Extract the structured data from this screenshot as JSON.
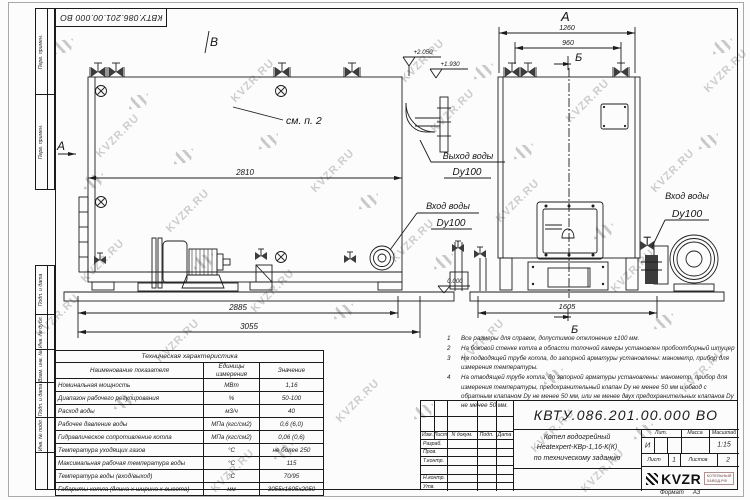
{
  "watermark": {
    "text": "KVZR.RU"
  },
  "frame": {
    "doc_number_top": "КВТУ.086.201.00.000 ВО",
    "col_perv_primen_1": "Перв. примен.",
    "col_perv_primen_2": "Перв. примен.",
    "col_podp_data_1": "Подп. и дата",
    "col_inv_dubl": "Инв. № дубл.",
    "col_vzam_inv": "Взам. инв. №",
    "col_podp_data_2": "Подп. и дата",
    "col_inv_podl": "Инв. № подл."
  },
  "drawing": {
    "side_view": {
      "label_v": "В",
      "section_a": "А",
      "see_note": "см. п. 2",
      "dim_inner": "2810",
      "dim_mid": "2885",
      "dim_total": "3055",
      "elev_top": "+2.050",
      "elev_upper": "+1.930",
      "elev_zero": "0.000",
      "outlet_title": "Выход воды",
      "outlet_dn": "Dy100",
      "inlet_title": "Вход воды",
      "inlet_dn": "Dy100"
    },
    "front_view": {
      "label_a": "А",
      "label_b_top": "Б",
      "label_b_bottom": "Б",
      "dim_outer": "1260",
      "dim_inner": "960",
      "dim_base": "1605",
      "inlet_title": "Вход воды",
      "inlet_dn": "Dy100"
    }
  },
  "notes": [
    {
      "num": "1",
      "text": "Все размеры для справок, допустимое отклонение ±100 мм."
    },
    {
      "num": "2",
      "text": "На боковой стенке котла в области топочной камеры установлен пробоотборный штуцер"
    },
    {
      "num": "3",
      "text": "На подводящей трубе котла, до запорной арматуры установлены: манометр, прибор для измерения температуры."
    },
    {
      "num": "4",
      "text": "На отводящей трубе котла, до запорной арматуры установлены: манометр, прибор для измерения температуры, предохранительный клапан Dу не менее 50 мм и обвод с обратным клапаном Dу не менее 50 мм, или не менее двух предохранительных клапанов Dу не менее 50 мм."
    }
  ],
  "spec_table": {
    "title": "Техническая характеристика",
    "col_name": "Наименование показателя",
    "col_units": "Единицы измерения",
    "col_value": "Значение",
    "rows": [
      {
        "name": "Номинальная мощность",
        "units": "МВт",
        "value": "1,16"
      },
      {
        "name": "Диапазон рабочего регулирования",
        "units": "%",
        "value": "50-100"
      },
      {
        "name": "Расход воды",
        "units": "м3/ч",
        "value": "40"
      },
      {
        "name": "Рабочее давление воды",
        "units": "МПа (кгс/см2)",
        "value": "0,6 (6,0)"
      },
      {
        "name": "Гидравлическое сопротивление котла",
        "units": "МПа (кгс/см2)",
        "value": "0,06 (0,6)"
      },
      {
        "name": "Температура уходящих газов",
        "units": "°С",
        "value": "не более 250"
      },
      {
        "name": "Максимальная рабочая температура воды",
        "units": "°С",
        "value": "115"
      },
      {
        "name": "Температура воды (вход/выход)",
        "units": "°С",
        "value": "70/95"
      },
      {
        "name": "Габариты котла (длина х ширина х высота)",
        "units": "мм",
        "value": "3055х1605х2050"
      }
    ]
  },
  "title_block": {
    "doc_number": "КВТУ.086.201.00.000 ВО",
    "rev_cols": {
      "izm": "Изм.",
      "list": "Лист",
      "ndoc": "N докум.",
      "podp": "Подп.",
      "data": "Дата"
    },
    "sign_rows": {
      "razrab": "Разраб.",
      "prov": "Пров.",
      "tkontr": "Т.контр.",
      "nkontr": "Н.контр.",
      "utv": "Утв."
    },
    "name_line1": "Котел водогрейный",
    "name_line2": "Heatexpert-КВр-1,16-К(К)",
    "name_line3": "по техническому заданию",
    "lit_label": "Лит.",
    "lit_value": "И",
    "mass_label": "Масса",
    "scale_label": "Масштаб",
    "scale_value": "1:15",
    "sheet_label": "Лист",
    "sheet_value": "1",
    "sheets_label": "Листов",
    "sheets_value": "2",
    "logo_text": "KVZR",
    "logo_sub1": "КОТЕЛЬНЫЙ",
    "logo_sub2": "ЗАВОД.РФ",
    "format_label": "Формат",
    "format_value": "А3"
  }
}
